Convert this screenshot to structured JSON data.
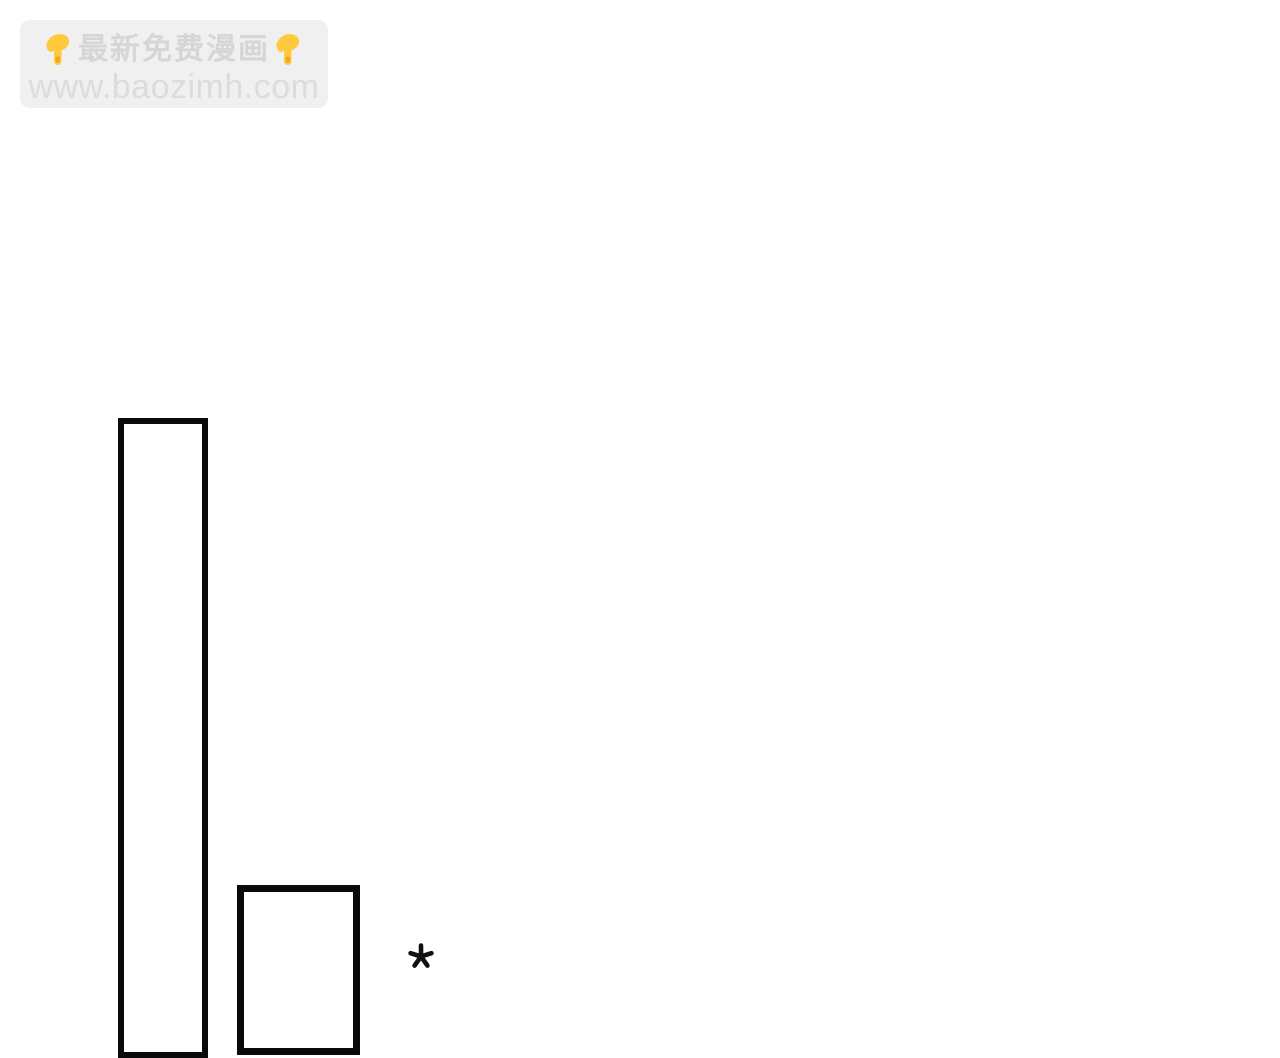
{
  "page": {
    "background_color": "#ffffff",
    "description": "comic page with watermark, two empty panel outlines and an asterisk"
  },
  "watermark": {
    "title": "最新免费漫画",
    "url": "www.baozimh.com",
    "left_emoji": "backhand-index-pointing-down",
    "right_emoji": "backhand-index-pointing-down",
    "background_color": "#f0f0f0",
    "title_color": "#d6d6d6",
    "url_color": "#dcdcdc",
    "emoji_main_color": "#ffc93c",
    "emoji_shade_color": "#eda625"
  },
  "comic": {
    "panel_border_color": "#0a0a0a",
    "panels": [
      {
        "name": "tall-panel"
      },
      {
        "name": "short-panel"
      }
    ],
    "asterisk_glyph": "*",
    "asterisk_color": "#111111"
  }
}
